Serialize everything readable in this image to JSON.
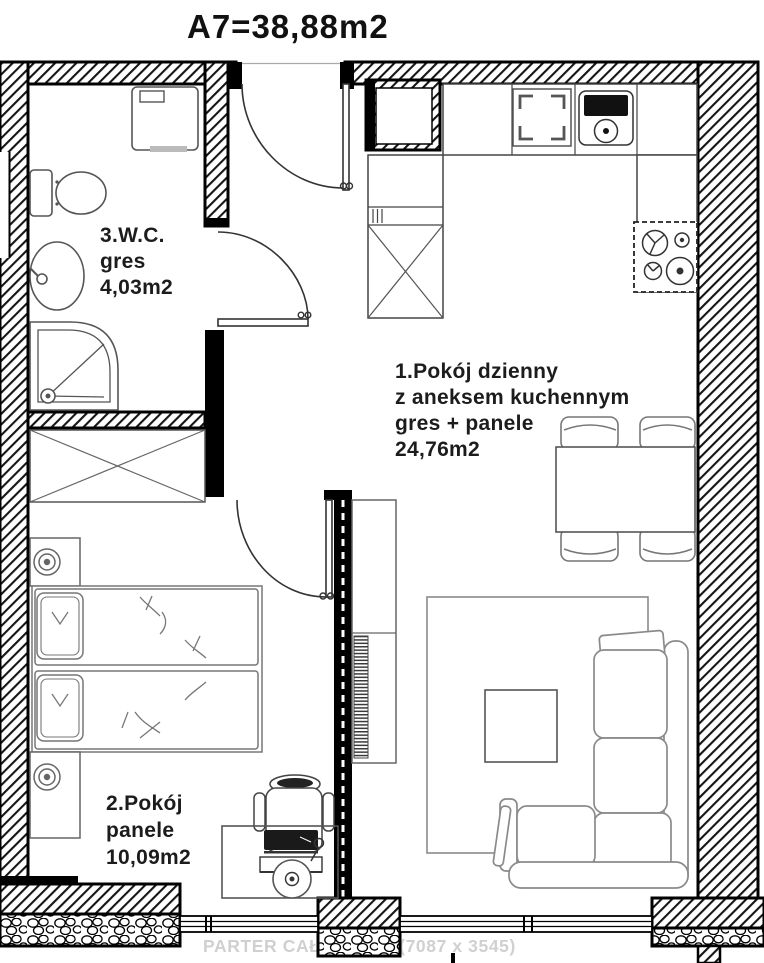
{
  "title": "A7=38,88m2",
  "rooms": {
    "living": {
      "name": "1.Pokój dzienny",
      "name2": "z aneksem kuchennym",
      "floor": "gres + panele",
      "area": "24,76m2"
    },
    "bedroom": {
      "name": "2.Pokój",
      "floor": "panele",
      "area": "10,09m2"
    },
    "wc": {
      "name": "3.W.C.",
      "floor": "gres",
      "area": "4,03m2"
    }
  },
  "watermark": "PARTER CAŁOŚĆ.jpg (7087 x 3545)",
  "colors": {
    "wall": "#000000",
    "furniture_stroke": "#666666",
    "light_stroke": "#8a8a8a",
    "label_text": "#1c1c1c",
    "watermark_text": "#d0d0d0",
    "background": "#ffffff"
  }
}
